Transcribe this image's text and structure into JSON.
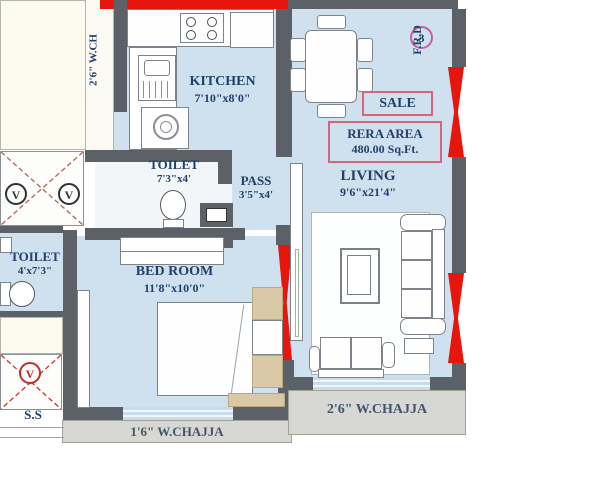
{
  "rooms": {
    "kitchen": {
      "name": "KITCHEN",
      "dim": "7'10\"x8'0\""
    },
    "toilet_attached": {
      "name": "TOILET",
      "dim": "7'3\"x4'"
    },
    "pass": {
      "name": "PASS",
      "dim": "3'5\"x4'"
    },
    "living": {
      "name": "LIVING",
      "dim": "9'6\"x21'4\""
    },
    "bedroom": {
      "name": "BED ROOM",
      "dim": "11'8\"x10'0\""
    },
    "toilet_common": {
      "name": "TOILET",
      "dim": "4'x7'3\""
    }
  },
  "annotations": {
    "sale": "SALE",
    "rera_title": "RERA AREA",
    "rera_value": "480.00 Sq.Ft.",
    "flat_number": "3",
    "fire_door": "F.R.D",
    "service_shaft": "S.S",
    "vent": "V",
    "chajja_top_left": "2'6\" W.CH",
    "chajja_bedroom": "1'6\" W.CHAJJA",
    "chajja_living": "2'6\" W.CHAJJA"
  },
  "colors": {
    "floor": "#cfe0ee",
    "wall": "#5b6167",
    "window_red": "#e8150c",
    "annotation_border": "#d86478",
    "label_text": "#23406b",
    "chajja_bg": "#d7d7d3",
    "furniture_tan": "#d9c9a6"
  }
}
